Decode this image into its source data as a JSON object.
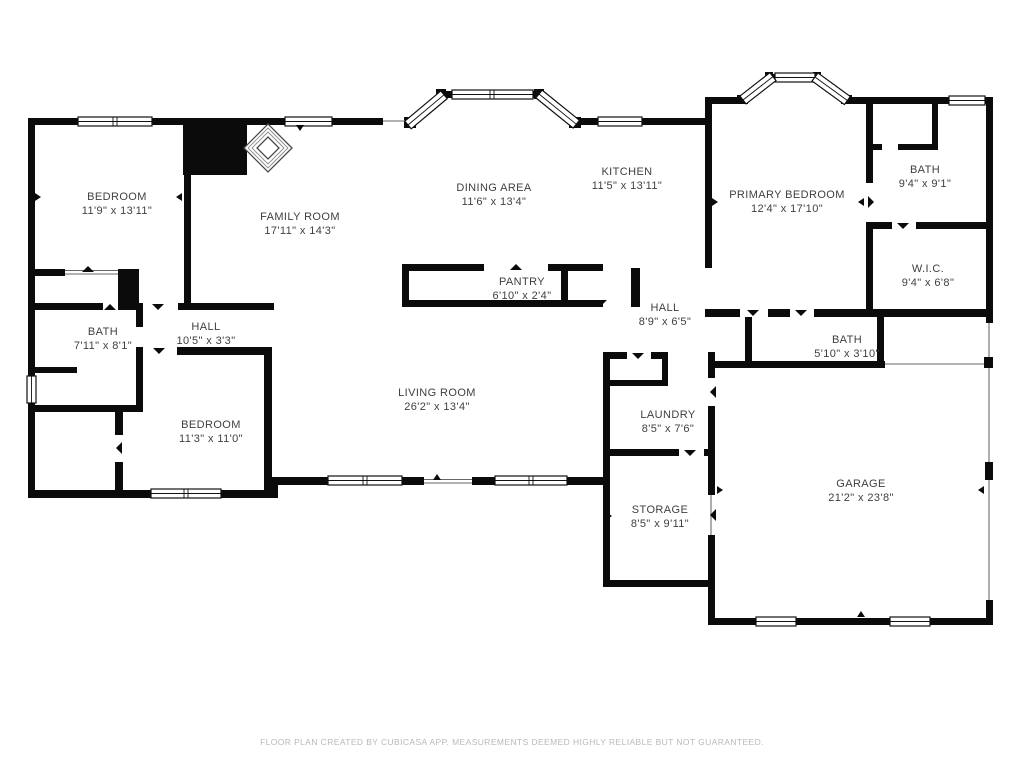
{
  "colors": {
    "walls": "#0b0b0b",
    "label_text": "#3f3f3f",
    "footer_text": "#b9b9b9",
    "background": "#ffffff"
  },
  "rooms": [
    {
      "id": "bedroom-1",
      "name": "BEDROOM",
      "dims": "11'9\" x 13'11\""
    },
    {
      "id": "family-room",
      "name": "FAMILY ROOM",
      "dims": "17'11\" x 14'3\""
    },
    {
      "id": "dining-area",
      "name": "DINING AREA",
      "dims": "11'6\" x 13'4\""
    },
    {
      "id": "kitchen",
      "name": "KITCHEN",
      "dims": "11'5\" x 13'11\""
    },
    {
      "id": "primary-bedroom",
      "name": "PRIMARY BEDROOM",
      "dims": "12'4\" x 17'10\""
    },
    {
      "id": "bath-top-right",
      "name": "BATH",
      "dims": "9'4\" x 9'1\""
    },
    {
      "id": "wic",
      "name": "W.I.C.",
      "dims": "9'4\" x 6'8\""
    },
    {
      "id": "pantry",
      "name": "PANTRY",
      "dims": "6'10\" x 2'4\""
    },
    {
      "id": "hall-right",
      "name": "HALL",
      "dims": "8'9\" x 6'5\""
    },
    {
      "id": "bath-middle",
      "name": "BATH",
      "dims": "5'10\" x 3'10\""
    },
    {
      "id": "bath-left",
      "name": "BATH",
      "dims": "7'11\" x 8'1\""
    },
    {
      "id": "hall-left",
      "name": "HALL",
      "dims": "10'5\" x 3'3\""
    },
    {
      "id": "bedroom-2",
      "name": "BEDROOM",
      "dims": "11'3\" x 11'0\""
    },
    {
      "id": "living-room",
      "name": "LIVING ROOM",
      "dims": "26'2\" x 13'4\""
    },
    {
      "id": "laundry",
      "name": "LAUNDRY",
      "dims": "8'5\" x 7'6\""
    },
    {
      "id": "storage",
      "name": "STORAGE",
      "dims": "8'5\" x 9'11\""
    },
    {
      "id": "garage",
      "name": "GARAGE",
      "dims": "21'2\" x 23'8\""
    }
  ],
  "footer": {
    "text": "FLOOR PLAN CREATED BY CUBICASA APP. MEASUREMENTS DEEMED HIGHLY RELIABLE BUT NOT GUARANTEED."
  }
}
